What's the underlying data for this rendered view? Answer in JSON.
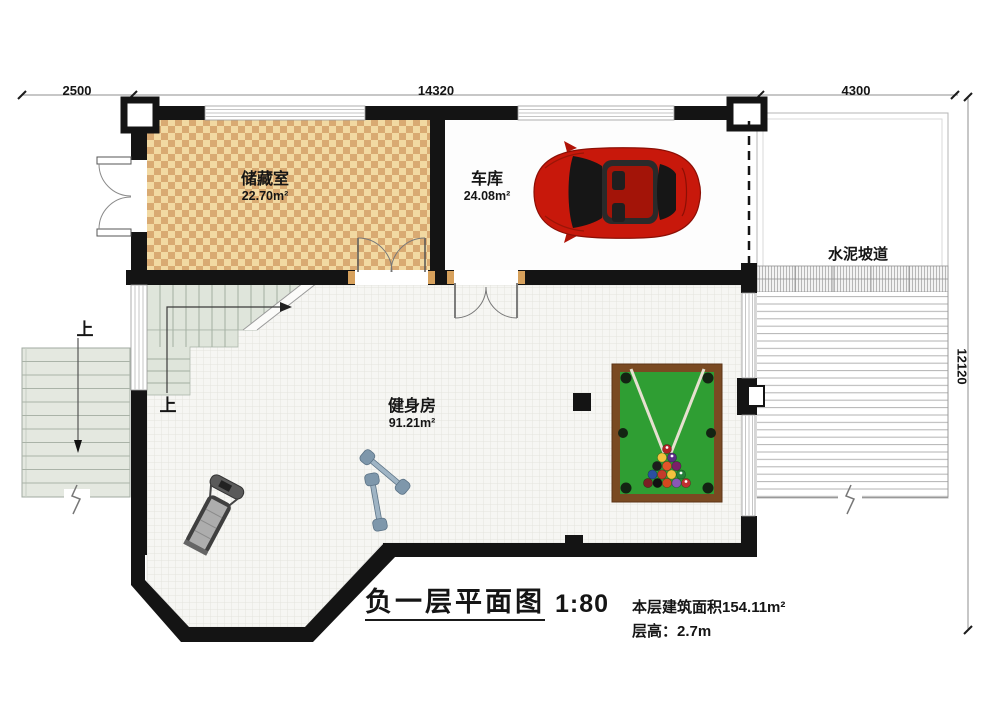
{
  "title_block": {
    "title": "负一层平面图",
    "scale": "1:80",
    "area": "本层建筑面积154.11m²",
    "floor_height": "层高：2.7m"
  },
  "dimensions": {
    "top_left": "2500",
    "top_middle": "14320",
    "top_right": "4300",
    "right": "12120"
  },
  "rooms": {
    "storage": {
      "name": "储藏室",
      "area": "22.70m²"
    },
    "garage": {
      "name": "车库",
      "area": "24.08m²"
    },
    "gym": {
      "name": "健身房",
      "area": "91.21m²"
    },
    "ramp": {
      "name": "水泥坡道"
    }
  },
  "stairs": {
    "exterior_up": "上",
    "interior_up": "上"
  },
  "colors": {
    "wall": "#141414",
    "checker_light": "#f2d9a2",
    "checker_dark": "#d9aa72",
    "pool_felt": "#2f9e33",
    "pool_frame": "#7a4a22",
    "car_red": "#c8180b",
    "stair_fill": "#e4e8e0"
  }
}
